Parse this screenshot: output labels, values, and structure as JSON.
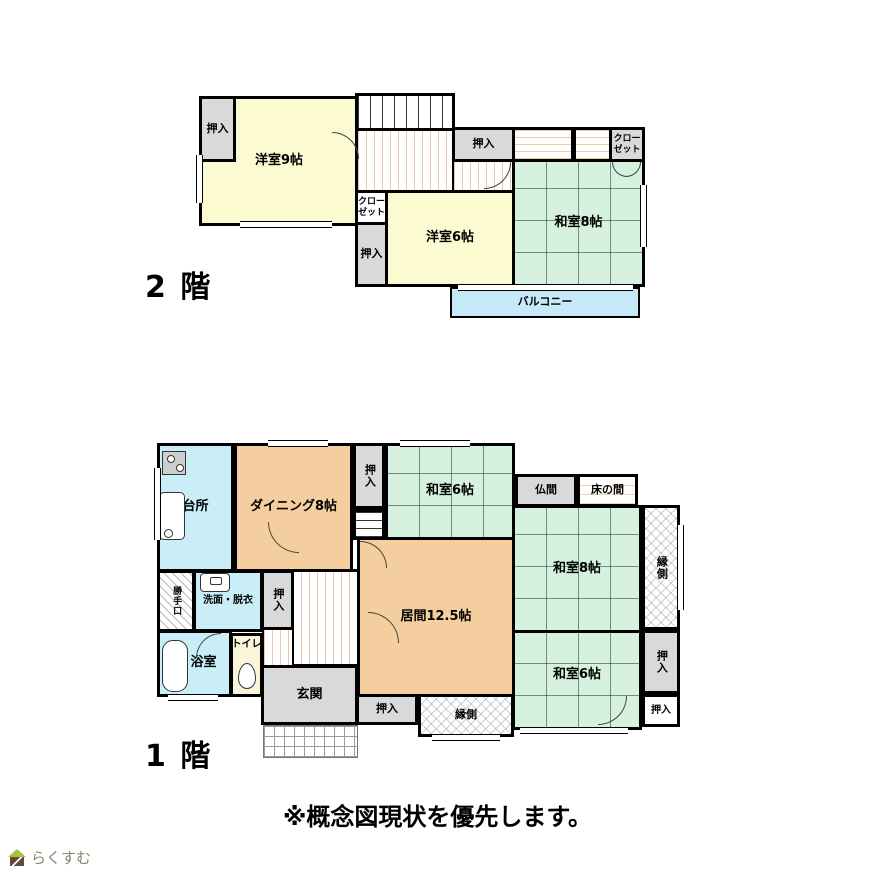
{
  "note": "※概念図現状を優先します。",
  "logo": {
    "text": "らくすむ"
  },
  "floor2": {
    "label": "2 階",
    "rooms": {
      "youshitsu9": {
        "label": "洋室9帖"
      },
      "oshiire_a": {
        "label": "押入"
      },
      "oshiire_b": {
        "label": "押入"
      },
      "closet_right": {
        "label": "クローゼット"
      },
      "washitsu8": {
        "label": "和室8帖"
      },
      "closet_left": {
        "label": "クローゼット"
      },
      "oshiire_c": {
        "label": "押入"
      },
      "youshitsu6": {
        "label": "洋室6帖"
      },
      "balcony": {
        "label": "バルコニー"
      }
    }
  },
  "floor1": {
    "label": "1 階",
    "rooms": {
      "daidokoro": {
        "label": "台所"
      },
      "dining": {
        "label": "ダイニング8帖"
      },
      "oshiire_top": {
        "label": "押入"
      },
      "washitsu6_top": {
        "label": "和室6帖"
      },
      "butsuma": {
        "label": "仏間"
      },
      "tokonoma": {
        "label": "床の間"
      },
      "engawa_right": {
        "label": "縁側"
      },
      "washitsu8": {
        "label": "和室8帖"
      },
      "katteguchi": {
        "label": "勝手口"
      },
      "senmen": {
        "label": "洗面・脱衣"
      },
      "oshiire_mid": {
        "label": "押入"
      },
      "ima": {
        "label": "居間12.5帖"
      },
      "yokushitsu": {
        "label": "浴室"
      },
      "toire": {
        "label": "トイレ"
      },
      "genkan": {
        "label": "玄関"
      },
      "oshiire_bottom": {
        "label": "押入"
      },
      "engawa_bottom": {
        "label": "縁側"
      },
      "washitsu6_br": {
        "label": "和室6帖"
      },
      "oshiire_right": {
        "label": "押入"
      },
      "oshiire_br": {
        "label": "押入"
      }
    }
  },
  "colors": {
    "western_room": "#FBFAD0",
    "tatami_room": "#D6F2DF",
    "wood_room": "#F4CE9E",
    "water_room": "#C9EEF7",
    "closet": "#D9D9D9",
    "balcony": "#C7E9F7",
    "toilet_room": "#FAF4D9",
    "wall": "#000000",
    "logo_text": "#8B8070",
    "logo_roof": "#A6C23C"
  }
}
